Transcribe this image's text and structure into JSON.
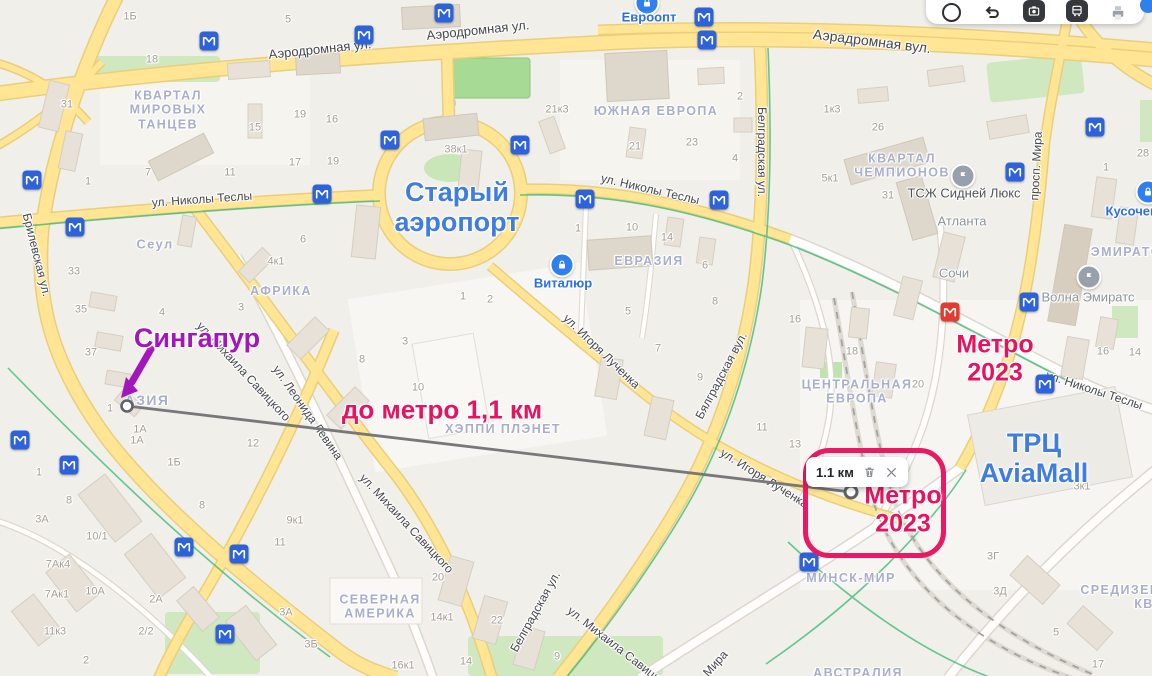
{
  "colors": {
    "annotation_pink": "#e8125f",
    "annotation_purple": "#a316bb",
    "place_blue": "#3f7de0",
    "highlight_border": "#eb1863",
    "metro_blue": "#2e62d9",
    "metro_red": "#e03c31",
    "road_yellow": "#ffe594",
    "park_green": "#cfe8c0",
    "poi_blue": "#2f80ed"
  },
  "toolbar": {
    "icons": [
      {
        "name": "traffic"
      },
      {
        "name": "routes"
      },
      {
        "name": "panorama"
      },
      {
        "name": "transport"
      },
      {
        "name": "print"
      }
    ]
  },
  "annotations": {
    "singapore_label": {
      "text": "Сингапур"
    },
    "to_metro_label": {
      "text": "до метро 1,1 км"
    },
    "metro_2023_ne": {
      "text": "Метро\n2023"
    },
    "metro_2023_box": {
      "text": "Метро\n2023"
    },
    "ruler": {
      "label": "1.1 км",
      "start_x": 127,
      "start_y": 406,
      "end_x": 851,
      "end_y": 492
    }
  },
  "map": {
    "place_labels": [
      {
        "text": "Старый\nаэропорт",
        "x": 457,
        "y": 207
      },
      {
        "text": "ТРЦ\nAviaMall",
        "x": 1034,
        "y": 458
      }
    ],
    "street_labels": [
      {
        "text": "Аэродромная ул.",
        "x": 320,
        "y": 50,
        "rot": -6,
        "fs": 13
      },
      {
        "text": "Аэродромная ул.",
        "x": 478,
        "y": 31,
        "rot": -6,
        "fs": 13
      },
      {
        "text": "Аэрадромная вул.",
        "x": 872,
        "y": 41,
        "rot": 7,
        "fs": 14
      },
      {
        "text": "ул. Николы Теслы",
        "x": 202,
        "y": 200,
        "rot": -4
      },
      {
        "text": "ул. Николы Теслы",
        "x": 650,
        "y": 190,
        "rot": 13
      },
      {
        "text": "ул. Николы Теслы",
        "x": 1094,
        "y": 391,
        "rot": 18
      },
      {
        "text": "Брилевская ул.",
        "x": 36,
        "y": 255,
        "rot": 76
      },
      {
        "text": "ул. Михаила Савицкого",
        "x": 243,
        "y": 372,
        "rot": 47
      },
      {
        "text": "ул. Михаила Савицкого",
        "x": 406,
        "y": 524,
        "rot": 47
      },
      {
        "text": "ул. Михаила Савицкого",
        "x": 620,
        "y": 650,
        "rot": 38
      },
      {
        "text": "ул. Леонида Левина",
        "x": 307,
        "y": 413,
        "rot": 55
      },
      {
        "text": "ул. Игоря Лученка",
        "x": 601,
        "y": 352,
        "rot": 44
      },
      {
        "text": "ул. Игоря Лученка",
        "x": 764,
        "y": 479,
        "rot": 32
      },
      {
        "text": "Белградская ул.",
        "x": 761,
        "y": 152,
        "rot": 90
      },
      {
        "text": "Бялградская вул.",
        "x": 722,
        "y": 376,
        "rot": -62
      },
      {
        "text": "Белградская ул.",
        "x": 536,
        "y": 612,
        "rot": -61
      },
      {
        "text": "просп. Мира",
        "x": 1037,
        "y": 166,
        "rot": -87
      },
      {
        "text": "Мира",
        "x": 716,
        "y": 664,
        "rot": -48
      }
    ],
    "district_labels": [
      {
        "text": "КВАРТАЛ\nМИРОВЫХ\nТАНЦЕВ",
        "x": 168,
        "y": 110
      },
      {
        "text": "ЮЖНАЯ ЕВРОПА",
        "x": 656,
        "y": 111
      },
      {
        "text": "КВАРТАЛ\nЧЕМПИОНОВ",
        "x": 902,
        "y": 166
      },
      {
        "text": "Сеул",
        "x": 155,
        "y": 245,
        "fs": 13
      },
      {
        "text": "АФРИКА",
        "x": 281,
        "y": 291
      },
      {
        "text": "ЕВРАЗИЯ",
        "x": 649,
        "y": 261
      },
      {
        "text": "ЦЕНТРАЛЬНАЯ\nЕВРОПА",
        "x": 857,
        "y": 392
      },
      {
        "text": "АЗИЯ",
        "x": 147,
        "y": 400,
        "fs": 14
      },
      {
        "text": "ХЭППИ ПЛЭНЕТ",
        "x": 503,
        "y": 429
      },
      {
        "text": "СЕВЕРНАЯ\nАМЕРИКА",
        "x": 380,
        "y": 607
      },
      {
        "text": "МИНСК-МИР",
        "x": 851,
        "y": 578
      },
      {
        "text": "АВСТРАЛИЯ",
        "x": 858,
        "y": 673
      },
      {
        "text": "СРЕДИЗЕМ",
        "x": 1121,
        "y": 590
      },
      {
        "text": "КВ",
        "x": 1144,
        "y": 604
      },
      {
        "text": "ЭМИРАТС",
        "x": 1126,
        "y": 252
      }
    ],
    "poi_labels": [
      {
        "text": "Евроопт",
        "x": 649,
        "y": 18,
        "style": "blue",
        "icon": "basket",
        "ix": 647,
        "iy": 3
      },
      {
        "text": "Виталюр",
        "x": 563,
        "y": 284,
        "style": "blue",
        "icon": "basket",
        "ix": 562,
        "iy": 265
      },
      {
        "text": "Кусочек",
        "x": 1131,
        "y": 212,
        "style": "blue",
        "icon": "basket",
        "ix": 1148,
        "iy": 192
      },
      {
        "text": "ТСЖ Сидней Люкс",
        "x": 964,
        "y": 194,
        "style": "dark",
        "icon": "flag",
        "ix": 963,
        "iy": 176
      },
      {
        "text": "Атланта",
        "x": 962,
        "y": 222,
        "style": "gray"
      },
      {
        "text": "Сочи",
        "x": 954,
        "y": 274,
        "style": "gray"
      },
      {
        "text": "Волна Эмиратс",
        "x": 1088,
        "y": 298,
        "style": "gray",
        "icon": "flag",
        "ix": 1089,
        "iy": 277
      }
    ],
    "metro_icons": [
      {
        "x": 209,
        "y": 41
      },
      {
        "x": 364,
        "y": 35
      },
      {
        "x": 444,
        "y": 13
      },
      {
        "x": 704,
        "y": 17
      },
      {
        "x": 707,
        "y": 40
      },
      {
        "x": 390,
        "y": 140
      },
      {
        "x": 520,
        "y": 145
      },
      {
        "x": 585,
        "y": 199
      },
      {
        "x": 719,
        "y": 200
      },
      {
        "x": 32,
        "y": 180
      },
      {
        "x": 75,
        "y": 227
      },
      {
        "x": 322,
        "y": 194
      },
      {
        "x": 1015,
        "y": 172
      },
      {
        "x": 1095,
        "y": 127
      },
      {
        "x": 1029,
        "y": 302
      },
      {
        "x": 1045,
        "y": 384
      },
      {
        "x": 20,
        "y": 440
      },
      {
        "x": 69,
        "y": 465
      },
      {
        "x": 184,
        "y": 547
      },
      {
        "x": 239,
        "y": 554
      },
      {
        "x": 225,
        "y": 634
      },
      {
        "x": 809,
        "y": 562
      },
      {
        "x": 950,
        "y": 312,
        "variant": "red"
      }
    ],
    "building_numbers": [
      [
        "31",
        67,
        105
      ],
      [
        "1Б",
        130,
        17
      ],
      [
        "18",
        152,
        60
      ],
      [
        "5",
        288,
        20
      ],
      [
        "15",
        255,
        128
      ],
      [
        "19",
        300,
        115
      ],
      [
        "16",
        332,
        120
      ],
      [
        "17",
        295,
        163
      ],
      [
        "19",
        333,
        162
      ],
      [
        "7",
        148,
        173
      ],
      [
        "1",
        88,
        182
      ],
      [
        "11",
        230,
        173
      ],
      [
        "33",
        74,
        272
      ],
      [
        "35",
        81,
        310
      ],
      [
        "37",
        91,
        353
      ],
      [
        "6",
        303,
        240
      ],
      [
        "4к1",
        276,
        262
      ],
      [
        "3",
        241,
        308
      ],
      [
        "4",
        162,
        313
      ],
      [
        "1",
        110,
        409
      ],
      [
        "8",
        362,
        360
      ],
      [
        "10",
        418,
        388
      ],
      [
        "1А",
        140,
        430
      ],
      [
        "38к1",
        456,
        150
      ],
      [
        "21к3",
        557,
        110
      ],
      [
        "21",
        635,
        147
      ],
      [
        "23",
        692,
        143
      ],
      [
        "2",
        740,
        97
      ],
      [
        "4",
        735,
        159
      ],
      [
        "1",
        578,
        229
      ],
      [
        "10",
        632,
        228
      ],
      [
        "14",
        667,
        238
      ],
      [
        "6",
        705,
        266
      ],
      [
        "1к3",
        832,
        110
      ],
      [
        "26",
        878,
        128
      ],
      [
        "5к1",
        830,
        179
      ],
      [
        "31",
        888,
        196
      ],
      [
        "1",
        1106,
        168
      ],
      [
        "28",
        1143,
        154
      ],
      [
        "16",
        1103,
        352
      ],
      [
        "14",
        1135,
        353
      ],
      [
        "20",
        918,
        385
      ],
      [
        "18",
        852,
        352
      ],
      [
        "16",
        795,
        320
      ],
      [
        "8",
        715,
        302
      ],
      [
        "5",
        628,
        312
      ],
      [
        "7",
        658,
        349
      ],
      [
        "9",
        700,
        378
      ],
      [
        "11",
        762,
        428
      ],
      [
        "13",
        795,
        445
      ],
      [
        "3к1",
        1082,
        487
      ],
      [
        "2",
        490,
        300
      ],
      [
        "1",
        463,
        297
      ],
      [
        "3",
        405,
        342
      ],
      [
        "3А",
        286,
        613
      ],
      [
        "3Б",
        311,
        645
      ],
      [
        "20",
        438,
        578
      ],
      [
        "14к1",
        442,
        618
      ],
      [
        "22",
        497,
        621
      ],
      [
        "16к1",
        403,
        666
      ],
      [
        "14",
        466,
        662
      ],
      [
        "9",
        557,
        657
      ],
      [
        "1",
        39,
        473
      ],
      [
        "1А",
        137,
        441
      ],
      [
        "1Б",
        174,
        463
      ],
      [
        "8",
        69,
        501
      ],
      [
        "3А",
        42,
        520
      ],
      [
        "10/1",
        97,
        537
      ],
      [
        "7Ак4",
        58,
        565
      ],
      [
        "7Ак1",
        57,
        595
      ],
      [
        "10А",
        95,
        592
      ],
      [
        "2А",
        156,
        600
      ],
      [
        "2/2",
        146,
        632
      ],
      [
        "11к3",
        55,
        632
      ],
      [
        "2",
        86,
        661
      ],
      [
        "8",
        202,
        506
      ],
      [
        "12",
        253,
        444
      ],
      [
        "9к1",
        295,
        521
      ],
      [
        "11",
        280,
        543
      ],
      [
        "3Г",
        993,
        557
      ],
      [
        "3Д",
        1000,
        592
      ],
      [
        "5",
        1056,
        633
      ],
      [
        "17",
        1098,
        665
      ],
      [
        "18",
        1118,
        16
      ]
    ]
  }
}
